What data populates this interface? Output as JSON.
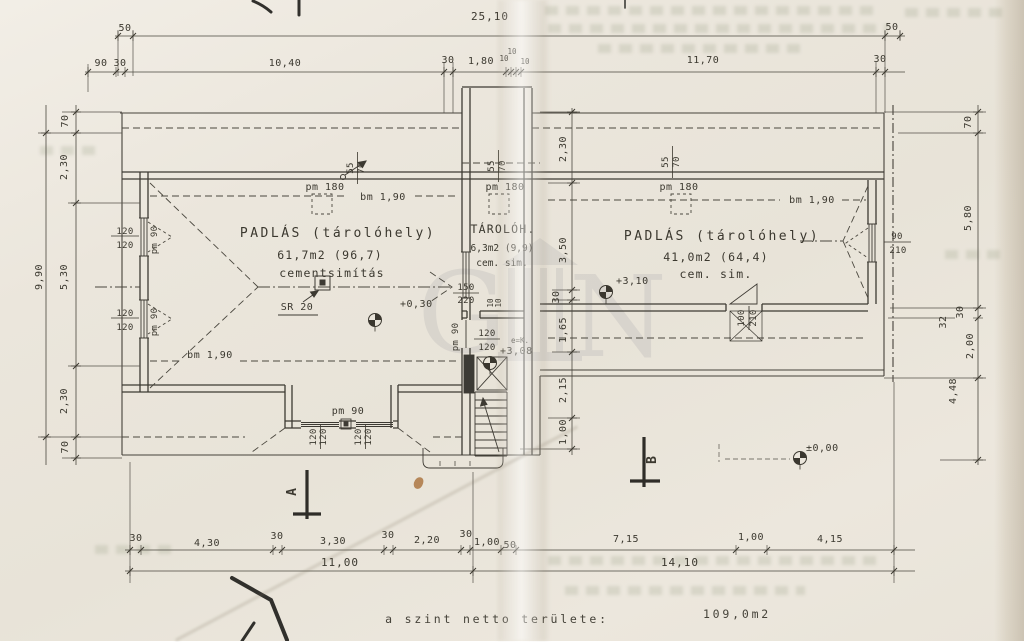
{
  "note": {
    "area_label": "a szint netto területe:",
    "area_value": "109,0m2"
  },
  "rooms": {
    "left": {
      "name": "PADLÁS (tárolóhely)",
      "area": "61,7m2 (96,7)",
      "finish": "cementsimítás"
    },
    "middle": {
      "name": "TÁROLÓH.",
      "area": "6,3m2 (9,9)",
      "finish": "cem. sim."
    },
    "right": {
      "name": "PADLÁS (tárolóhely)",
      "area": "41,0m2 (64,4)",
      "finish": "cem. sim."
    }
  },
  "levels": {
    "left": "+0,30",
    "stair": "+3,08",
    "right": "+3,10",
    "ground": "±0,00"
  },
  "sections": {
    "a": "A",
    "b": "B"
  },
  "notes": {
    "sr20": "SR 20",
    "stair_e": "e=K."
  },
  "dims": {
    "top_overall": "25,10",
    "top_50_left": "50",
    "top_50_right": "50",
    "top_row": [
      "90",
      "30",
      "10,40",
      "30",
      "1,80",
      "10",
      "10",
      "10",
      "11,70",
      "30"
    ],
    "bottom_row": [
      "30",
      "4,30",
      "30",
      "3,30",
      "30",
      "2,20",
      "30",
      "1,00",
      "50",
      "7,15",
      "1,00",
      "4,15"
    ],
    "bottom_total_left": "11,00",
    "bottom_total_right": "14,10",
    "left_total": "9,90",
    "left_col": [
      "70",
      "2,30",
      "5,30",
      "2,30",
      "70"
    ],
    "right_col": [
      "70",
      "5,80",
      "30",
      "32",
      "2,00",
      "4,48"
    ],
    "mid_col": [
      "2,30",
      "3,50",
      "30",
      "1,65",
      "2,15",
      "1,00"
    ],
    "stair_small": [
      "10",
      "10"
    ]
  },
  "openings": {
    "win120": {
      "w": "120",
      "h": "120"
    },
    "pm90": "pm 90",
    "pm180": "pm 180",
    "bm190": "bm 1,90",
    "win150220": {
      "w": "150",
      "h": "220"
    },
    "win90210": {
      "w": "90",
      "h": "210"
    },
    "door100210": {
      "w": "100",
      "h": "210"
    },
    "rafter5570": {
      "w": "55",
      "h": "70"
    }
  },
  "watermark": {
    "letters": [
      "G",
      "N"
    ]
  }
}
